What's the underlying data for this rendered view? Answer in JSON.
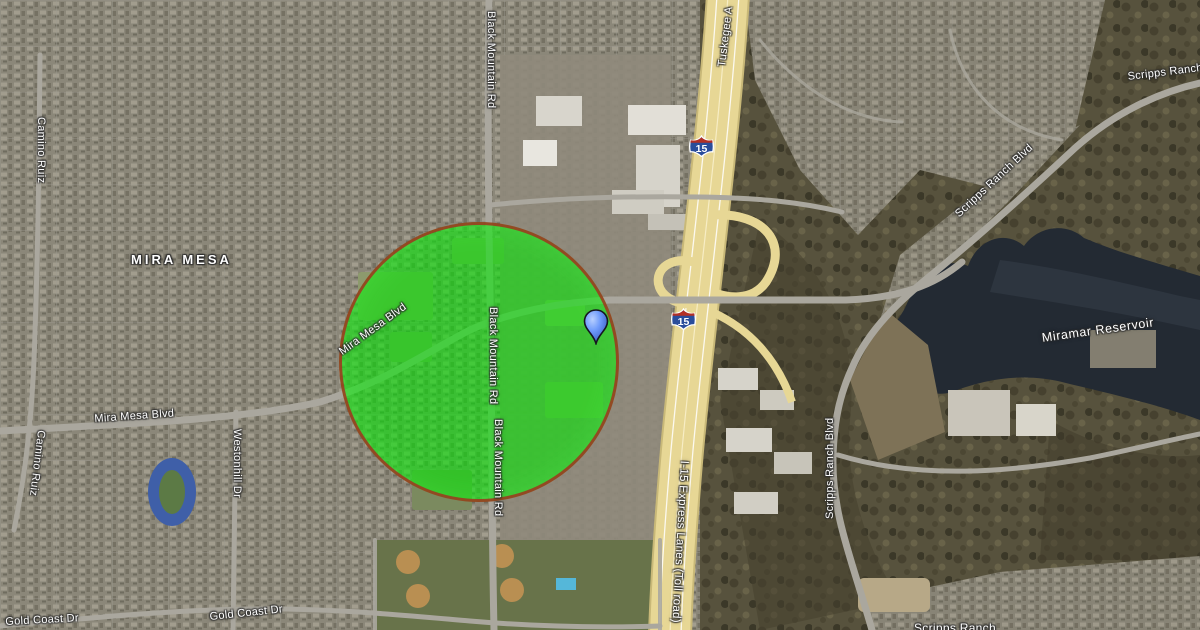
{
  "map": {
    "area_label": "MIRA MESA",
    "water_label": "Miramar Reservoir",
    "shields": [
      {
        "text": "15"
      },
      {
        "text": "15"
      }
    ],
    "labels": [
      {
        "text": "MIRA MESA"
      },
      {
        "text": "Black Mountain Rd"
      },
      {
        "text": "Tuskegee A"
      },
      {
        "text": "Scripps Ranch Blvd"
      },
      {
        "text": "Scripps Ranch Blvd"
      },
      {
        "text": "Miramar Reservoir"
      },
      {
        "text": "Scripps Ranch Blvd"
      },
      {
        "text": "Black Mountain Rd"
      },
      {
        "text": "Black Mountain Rd"
      },
      {
        "text": "Mira Mesa Blvd"
      },
      {
        "text": "Mira Mesa Blvd"
      },
      {
        "text": "Camino Ruiz"
      },
      {
        "text": "Camino Ruiz"
      },
      {
        "text": "Westonhill Dr"
      },
      {
        "text": "Gold Coast Dr"
      },
      {
        "text": "Gold Coast Dr"
      },
      {
        "text": "I-15 Express Lanes (Toll road)"
      },
      {
        "text": "Scripps Ranch"
      }
    ]
  },
  "overlay": {
    "geofence_circle": {
      "center_x": 482,
      "center_y": 365,
      "radius": 140,
      "fill_color": "#00e800",
      "fill_opacity": 0.58,
      "border_color": "#9e3a20"
    },
    "marker": {
      "x": 596,
      "y": 344,
      "color": "#6f9bfb"
    }
  },
  "colors": {
    "highway": "#e7d795",
    "water": "#232a33",
    "urban": "#8b8779",
    "scrub": "#57523d"
  }
}
